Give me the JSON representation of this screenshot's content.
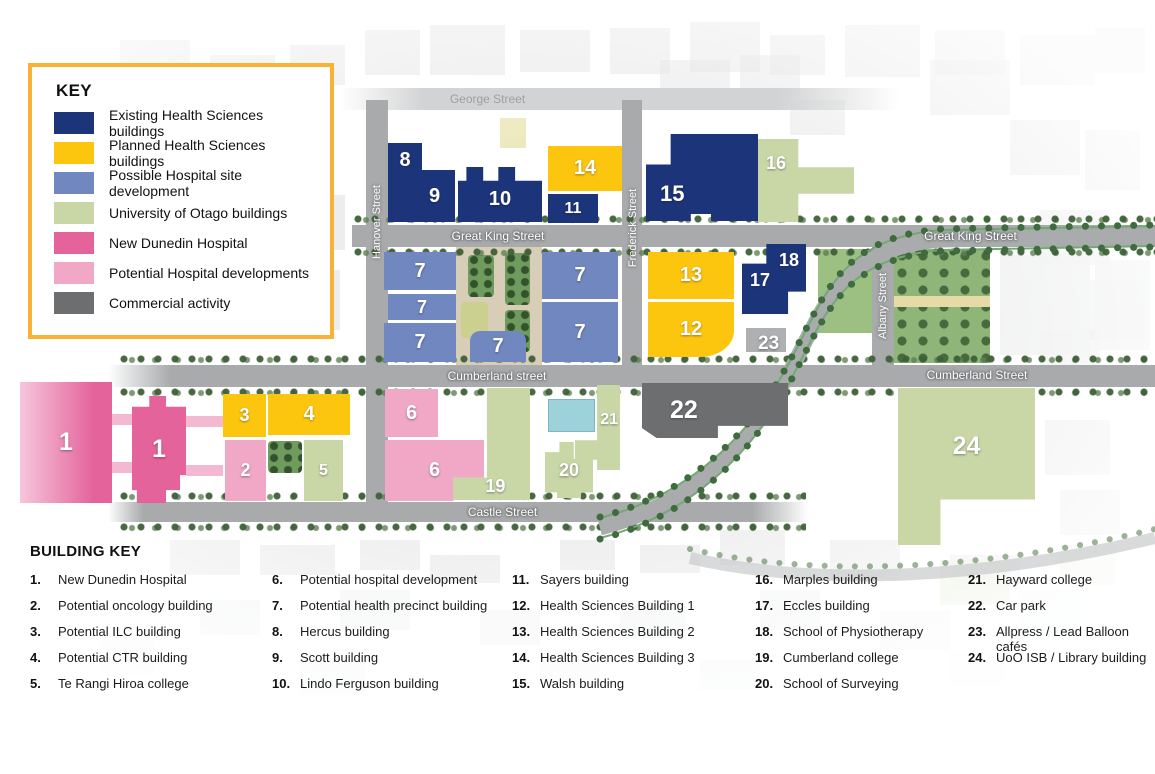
{
  "legend": {
    "title": "KEY",
    "items": [
      {
        "label": "Existing Health Sciences buildings",
        "color": "#1c3479"
      },
      {
        "label": "Planned Health Sciences buildings",
        "color": "#fdc60e"
      },
      {
        "label": "Possible Hospital site development",
        "color": "#7187bf"
      },
      {
        "label": "University of Otago buildings",
        "color": "#c8d7a5"
      },
      {
        "label": "New Dunedin Hospital",
        "color": "#e4639b"
      },
      {
        "label": "Potential Hospital developments",
        "color": "#f1a7c6"
      },
      {
        "label": "Commercial activity",
        "color": "#6d6e70"
      }
    ]
  },
  "building_key": {
    "title": "BUILDING KEY",
    "columns": [
      [
        {
          "n": "1.",
          "t": "New Dunedin Hospital"
        },
        {
          "n": "2.",
          "t": "Potential oncology building"
        },
        {
          "n": "3.",
          "t": "Potential ILC building"
        },
        {
          "n": "4.",
          "t": "Potential CTR building"
        },
        {
          "n": "5.",
          "t": "Te Rangi Hiroa college"
        }
      ],
      [
        {
          "n": "6.",
          "t": "Potential hospital development"
        },
        {
          "n": "7.",
          "t": "Potential health precinct building"
        },
        {
          "n": "8.",
          "t": "Hercus building"
        },
        {
          "n": "9.",
          "t": "Scott building"
        },
        {
          "n": "10.",
          "t": "Lindo Ferguson building"
        }
      ],
      [
        {
          "n": "11.",
          "t": "Sayers building"
        },
        {
          "n": "12.",
          "t": "Health Sciences Building 1"
        },
        {
          "n": "13.",
          "t": "Health Sciences Building 2"
        },
        {
          "n": "14.",
          "t": "Health Sciences Building 3"
        },
        {
          "n": "15.",
          "t": "Walsh building"
        }
      ],
      [
        {
          "n": "16.",
          "t": "Marples building"
        },
        {
          "n": "17.",
          "t": "Eccles building"
        },
        {
          "n": "18.",
          "t": "School of Physiotherapy"
        },
        {
          "n": "19.",
          "t": "Cumberland college"
        },
        {
          "n": "20.",
          "t": "School of Surveying"
        }
      ],
      [
        {
          "n": "21.",
          "t": "Hayward college"
        },
        {
          "n": "22.",
          "t": "Car park"
        },
        {
          "n": "23.",
          "t": "Allpress / Lead Balloon cafés"
        },
        {
          "n": "24.",
          "t": "UoO ISB / Library building"
        }
      ]
    ]
  },
  "streets": {
    "george": "George Street",
    "great_king_center": "Great King Street",
    "great_king_right": "Great King Street",
    "cumberland_center": "Cumberland street",
    "cumberland_right": "Cumberland Street",
    "castle": "Castle Street",
    "hanover": "Hanover Street",
    "frederick": "Frederick Street",
    "albany": "Albany Street"
  },
  "map_labels": {
    "b1a": "1",
    "b1b": "1",
    "b2": "2",
    "b3": "3",
    "b4": "4",
    "b5": "5",
    "b6a": "6",
    "b6b": "6",
    "b7_1": "7",
    "b7_2": "7",
    "b7_3": "7",
    "b7_4": "7",
    "b7_5": "7",
    "b7_6": "7",
    "b8": "8",
    "b9": "9",
    "b10": "10",
    "b11": "11",
    "b12": "12",
    "b13": "13",
    "b14": "14",
    "b15": "15",
    "b16": "16",
    "b17": "17",
    "b18": "18",
    "b19": "19",
    "b20": "20",
    "b21": "21",
    "b22": "22",
    "b23": "23",
    "b24": "24"
  }
}
